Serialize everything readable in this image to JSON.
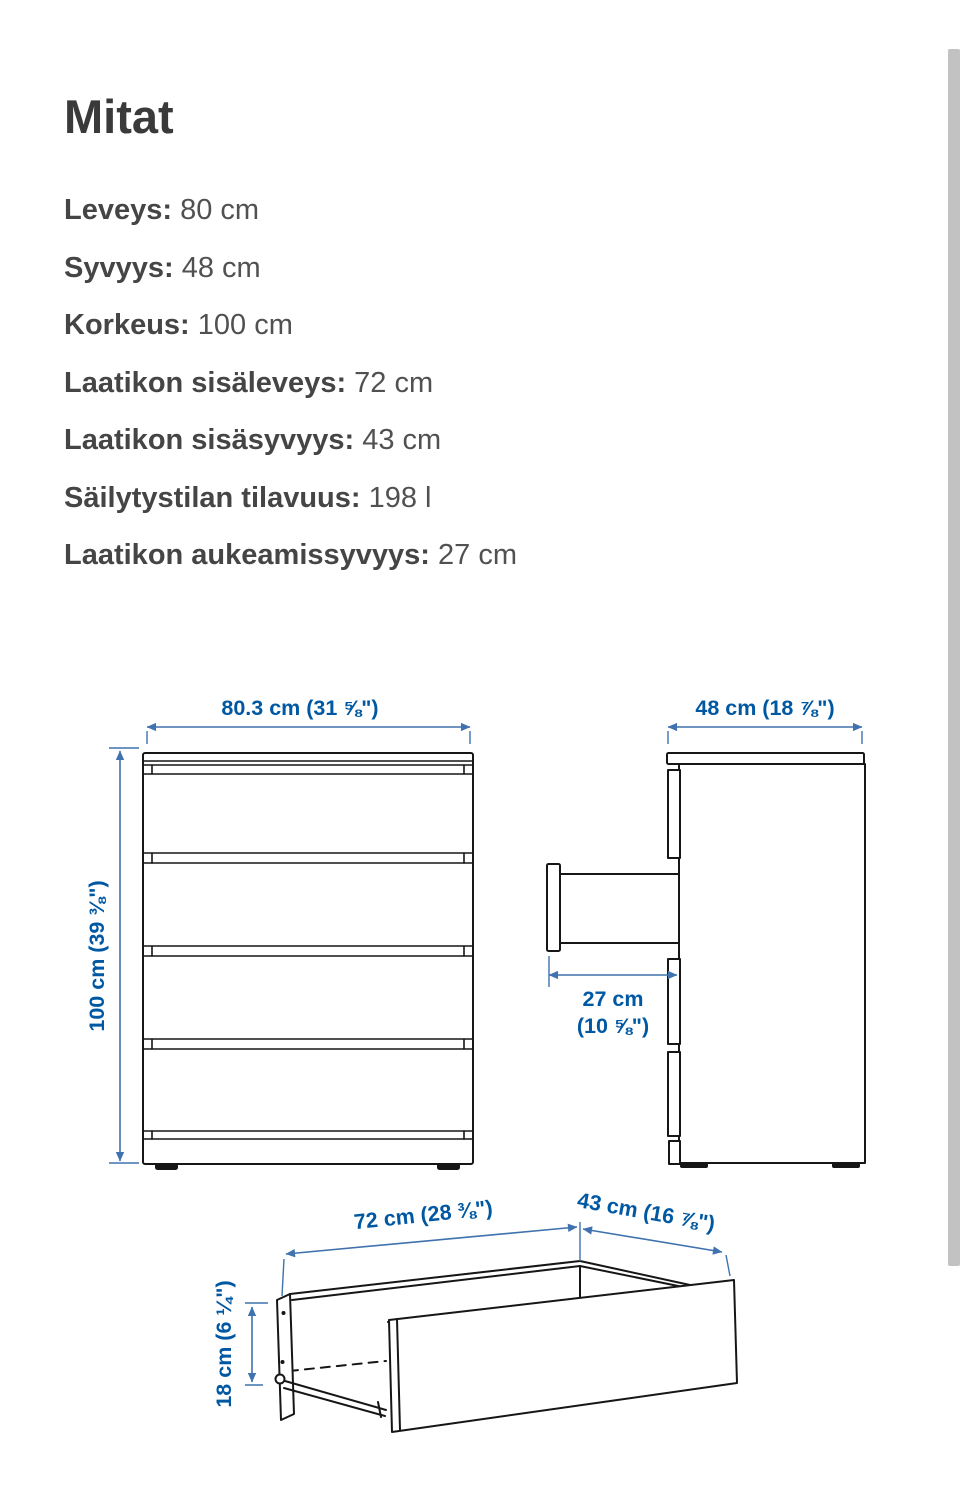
{
  "page": {
    "title": "Mitat"
  },
  "dimensions_list": [
    {
      "label": "Leveys:",
      "value": "80 cm"
    },
    {
      "label": "Syvyys:",
      "value": "48 cm"
    },
    {
      "label": "Korkeus:",
      "value": "100 cm"
    },
    {
      "label": "Laatikon sisäleveys:",
      "value": "72 cm"
    },
    {
      "label": "Laatikon sisäsyvyys:",
      "value": "43 cm"
    },
    {
      "label": "Säilytystilan tilavuus:",
      "value": "198 l"
    },
    {
      "label": "Laatikon aukeamissyvyys:",
      "value": "27 cm"
    }
  ],
  "diagram": {
    "front_width_label": "80.3 cm (31 ⅝\")",
    "front_height_label": "100 cm (39 ⅜\")",
    "side_depth_label": "48 cm (18 ⅞\")",
    "open_depth_label_line1": "27 cm",
    "open_depth_label_line2": "(10 ⅝\")",
    "drawer_width_label": "72 cm (28 ⅜\")",
    "drawer_depth_label": "43 cm (16 ⅞\")",
    "drawer_height_label": "18 cm (6 ¼\")"
  },
  "colors": {
    "dimension_text": "#0058a3",
    "dimension_line": "#3f72ae",
    "drawing_line": "#161616",
    "body_text": "#4a4a4a",
    "title_text": "#3a3a3a",
    "scrollbar_thumb": "#c2c2c2"
  }
}
